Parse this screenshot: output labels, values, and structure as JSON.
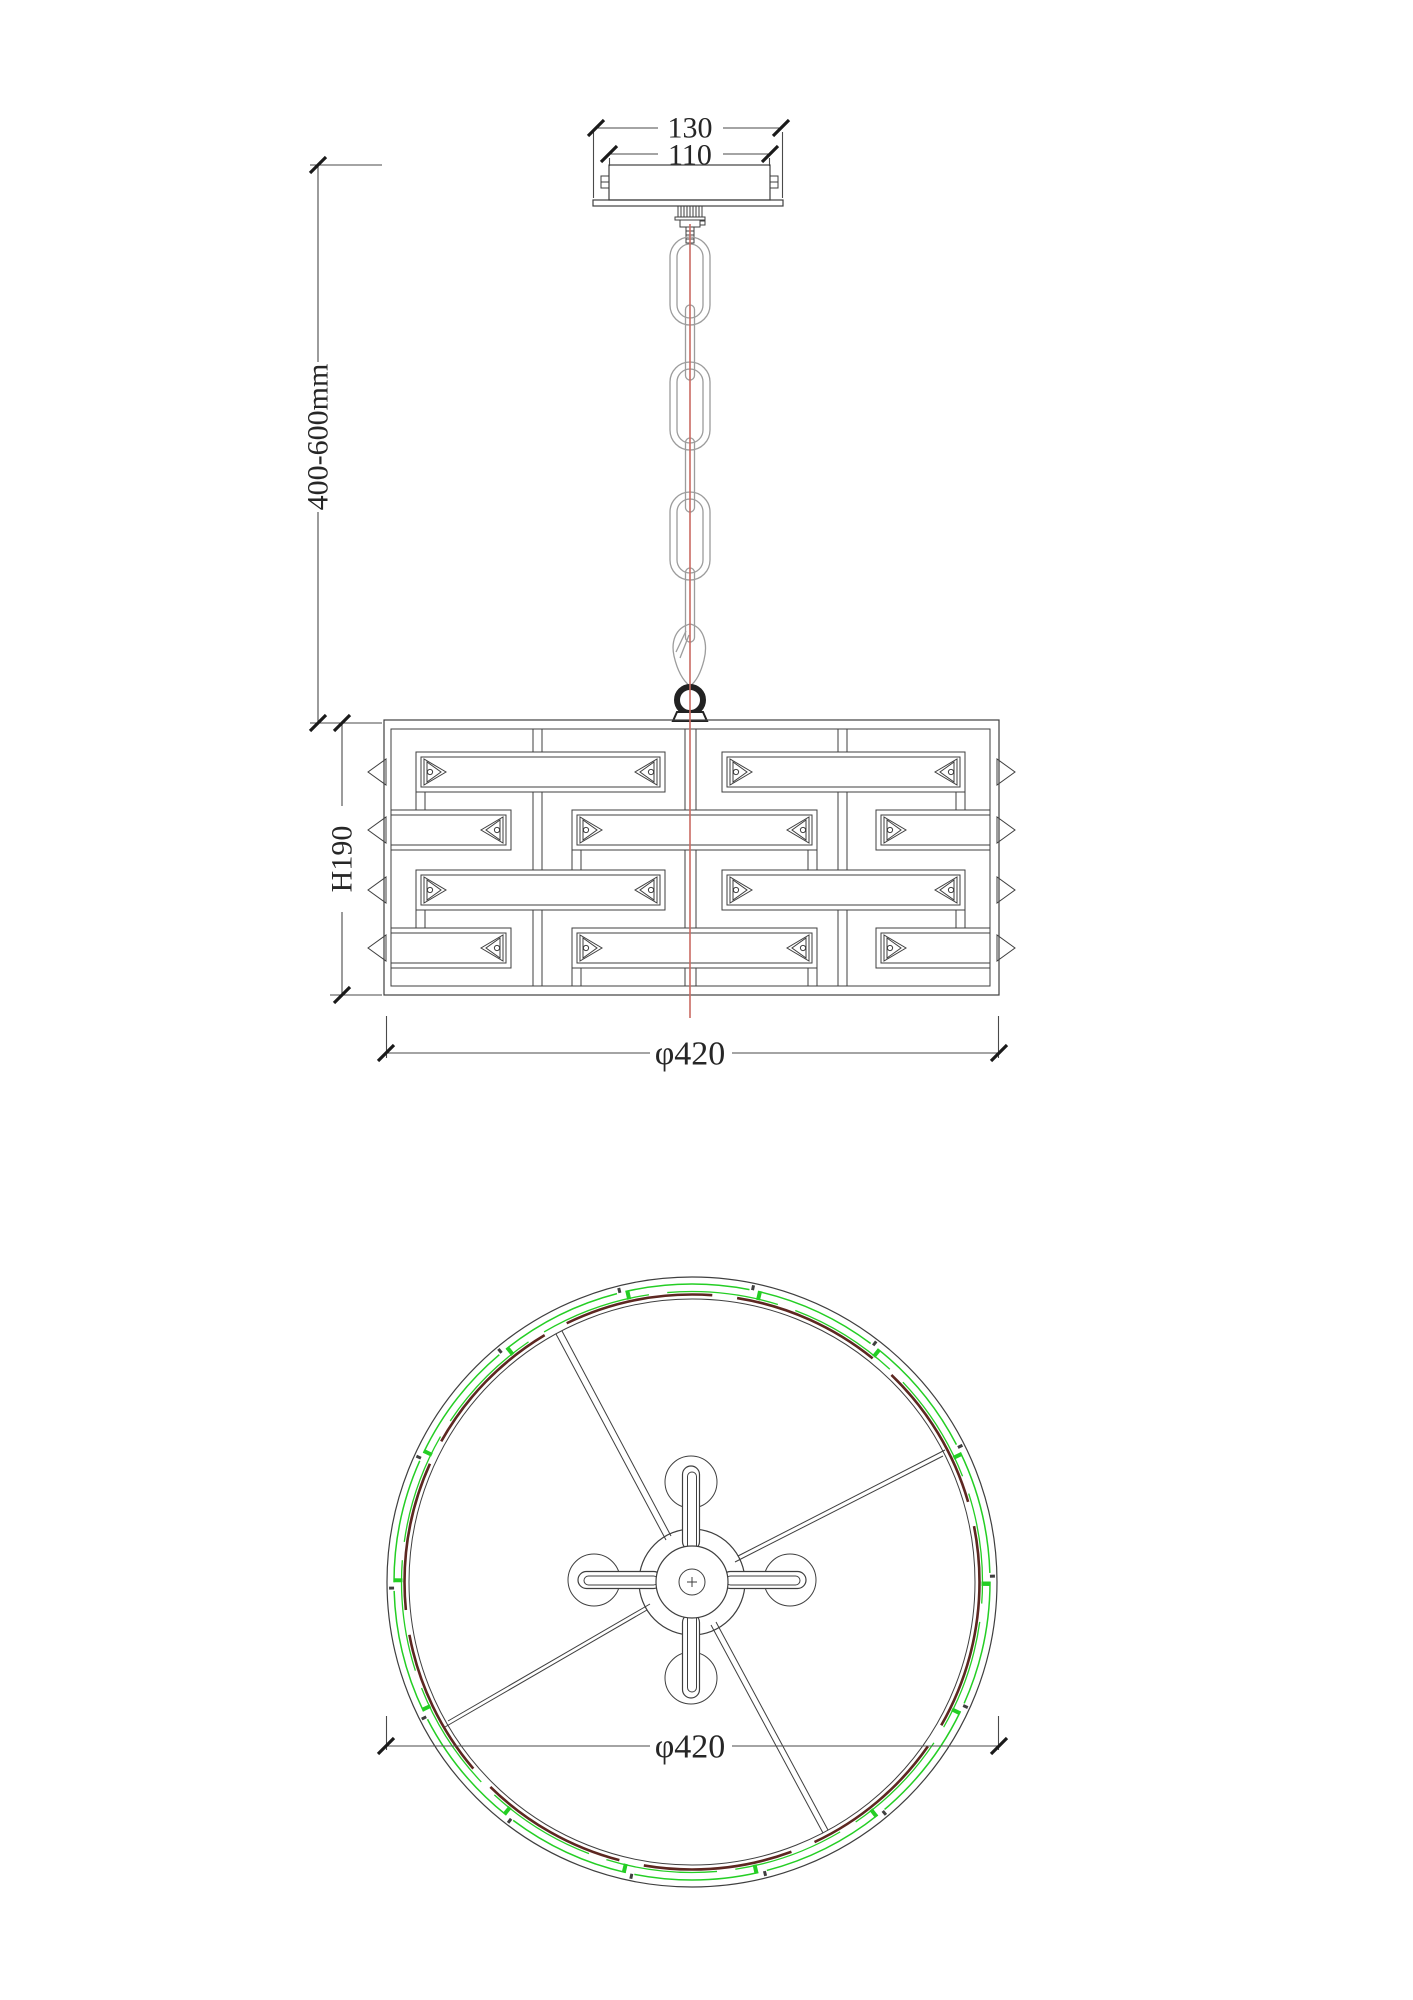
{
  "drawing": {
    "side_view": {
      "canopy_plate_width": "130",
      "canopy_body_width": "110",
      "suspension_length": "400-600mm",
      "shade_height": "H190",
      "shade_diameter": "φ420"
    },
    "plan_view": {
      "shade_diameter": "φ420"
    },
    "colors": {
      "line": "#3f3f3f",
      "chain": "#9c9c9c",
      "centerline_red": "#c96b62",
      "crystal_green": "#24ce24",
      "rim_maroon": "#5d2721"
    }
  }
}
